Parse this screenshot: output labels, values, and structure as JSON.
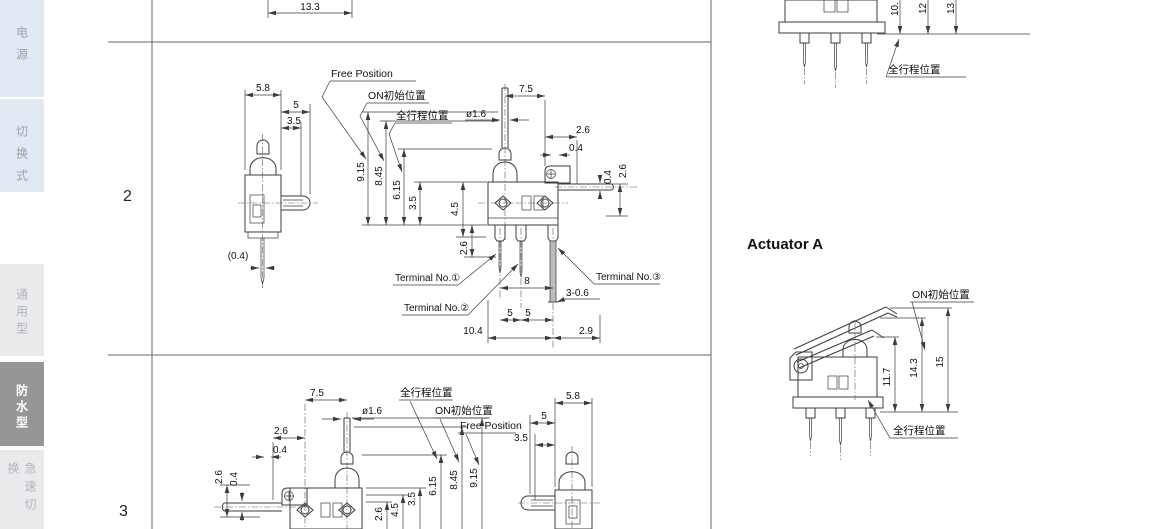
{
  "sidebar": {
    "tabs": [
      {
        "label": "电源"
      },
      {
        "label": "切换式"
      },
      {
        "label": "通用型"
      },
      {
        "label": "防水型"
      },
      {
        "label": "急速切换"
      }
    ]
  },
  "row_numbers": {
    "r2": "2",
    "r3": "3"
  },
  "terms": {
    "free_position": "Free Position",
    "on_initial": "ON初始位置",
    "full_stroke": "全行程位置"
  },
  "top_dim": {
    "width": "13.3"
  },
  "row2": {
    "side": {
      "w": "5.8",
      "l1": "5",
      "l2": "3.5",
      "offset": "(0.4)"
    },
    "stack": {
      "free": "9.15",
      "on": "8.45",
      "full": "6.15",
      "body": "3.5"
    },
    "front": {
      "pitch": "7.5",
      "dia": "ø1.6",
      "r1": "2.6",
      "r2": "0.4",
      "rv1": "0.4",
      "rv2": "2.6",
      "lv1": "4.5",
      "lv2": "2.6",
      "pitch8": "8",
      "hole": "3-0.6",
      "p5a": "5",
      "p5b": "5",
      "w104": "10.4",
      "ext29": "2.9"
    },
    "terminals": {
      "t1": "Terminal No.①",
      "t2": "Terminal No.②",
      "t3": "Terminal No.③"
    }
  },
  "row3": {
    "front": {
      "pitch": "7.5",
      "dia": "ø1.6",
      "l1": "2.6",
      "l2": "0.4",
      "lv1": "2.6",
      "lv2": "0.4",
      "bv1": "2.6",
      "bv2": "4.5"
    },
    "stack": {
      "body": "3.5",
      "full": "6.15",
      "on": "8.45",
      "free": "9.15"
    },
    "side": {
      "w": "5.8",
      "l1": "5",
      "l2": "3.5"
    }
  },
  "top_right": {
    "d1": "10.",
    "d2": "12",
    "d3": "13"
  },
  "actuator": {
    "heading": "Actuator A",
    "h1": "11.7",
    "h2": "14.3",
    "h3": "15"
  }
}
